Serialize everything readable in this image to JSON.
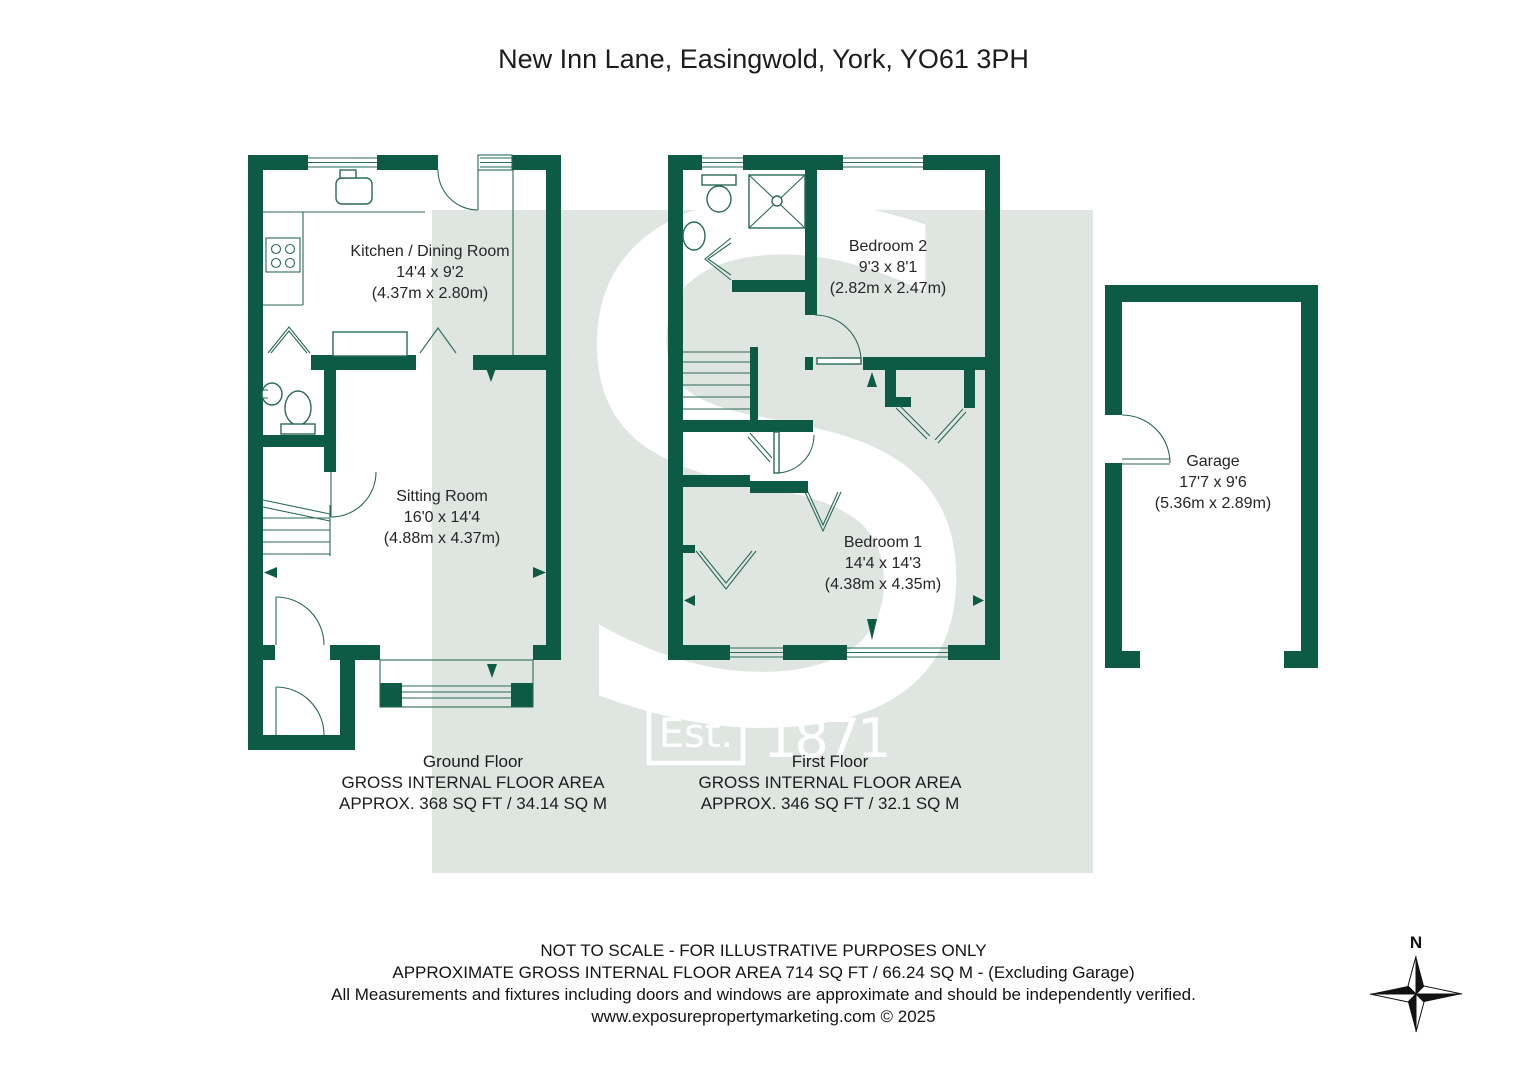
{
  "title": "New Inn Lane, Easingwold, York, YO61 3PH",
  "colors": {
    "wall": "#0d5a45",
    "band": "#dfe6e2",
    "line": "#2a6a56",
    "text": "#262626"
  },
  "watermark": {
    "est": "Est.",
    "year": "1871",
    "letter": "S"
  },
  "compass": {
    "north": "N"
  },
  "rooms": {
    "kitchen": {
      "name": "Kitchen / Dining Room",
      "size_imperial": "14'4 x 9'2",
      "size_metric": "(4.37m x 2.80m)"
    },
    "sitting": {
      "name": "Sitting Room",
      "size_imperial": "16'0 x 14'4",
      "size_metric": "(4.88m x 4.37m)"
    },
    "bedroom2": {
      "name": "Bedroom 2",
      "size_imperial": "9'3 x 8'1",
      "size_metric": "(2.82m x 2.47m)"
    },
    "bedroom1": {
      "name": "Bedroom 1",
      "size_imperial": "14'4 x 14'3",
      "size_metric": "(4.38m x 4.35m)"
    },
    "garage": {
      "name": "Garage",
      "size_imperial": "17'7 x 9'6",
      "size_metric": "(5.36m x 2.89m)"
    }
  },
  "floor_summaries": {
    "ground": {
      "name": "Ground Floor",
      "area_label": "GROSS INTERNAL FLOOR AREA",
      "area_value": "APPROX. 368 SQ FT / 34.14 SQ M"
    },
    "first": {
      "name": "First Floor",
      "area_label": "GROSS INTERNAL FLOOR AREA",
      "area_value": "APPROX. 346 SQ FT / 32.1 SQ M"
    }
  },
  "footer": {
    "line1": "NOT TO SCALE - FOR ILLUSTRATIVE PURPOSES ONLY",
    "line2": "APPROXIMATE GROSS INTERNAL FLOOR AREA 714 SQ FT / 66.24 SQ M - (Excluding Garage)",
    "line3": "All Measurements and fixtures including doors and windows are approximate and should be independently verified.",
    "line4": "www.exposurepropertymarketing.com © 2025"
  }
}
